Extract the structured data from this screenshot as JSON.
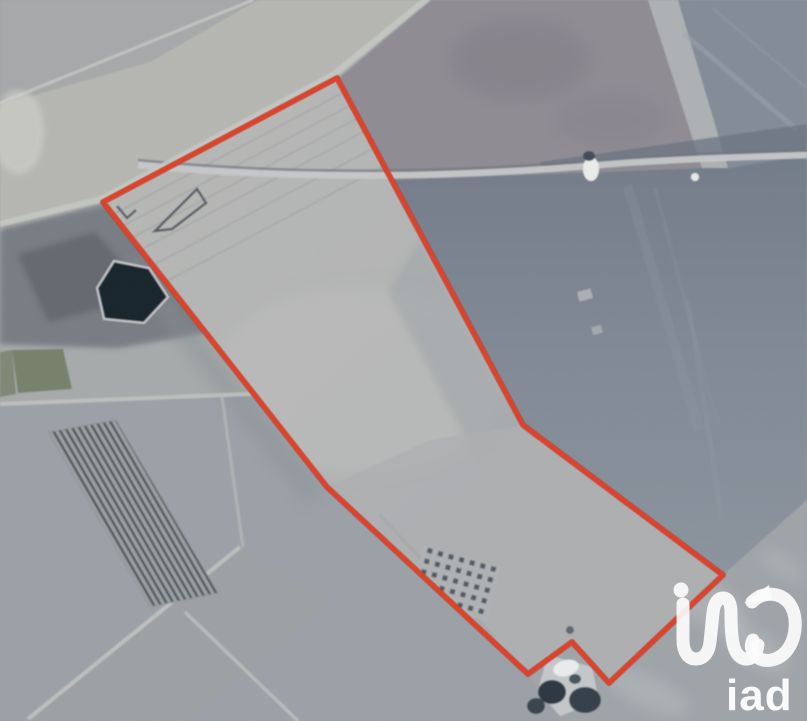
{
  "scene": {
    "type": "satellite aerial photo",
    "description": "Aerial satellite view of agricultural fields and tracks with a red property-boundary polygon overlay and an iad real-estate watermark",
    "palette": {
      "base_field": "#9aa0a6",
      "pale_field_upper_left": "#b5b6b1",
      "purple_field_top": "#8e8a92",
      "dark_field_right": "#7d8692",
      "parcel_interior_light": "#b6b7b4",
      "road_light": "#c5c7c8",
      "pond_dark": "#18232c",
      "vegetation_green": "#75806b",
      "scrub_dark": "#6e737a",
      "vineyard_rows_dark": "#4d555b"
    }
  },
  "parcel_outline": {
    "color": "#dc432c",
    "halo_color": "#b03524",
    "stroke_width": 5,
    "points_str": "103,202 337,78 523,425 723,575 609,683 572,642 528,674 327,487"
  },
  "watermark": {
    "brand": "iad",
    "text": "iad",
    "color": "#ffffff",
    "icon": "iad-loop-logo"
  }
}
